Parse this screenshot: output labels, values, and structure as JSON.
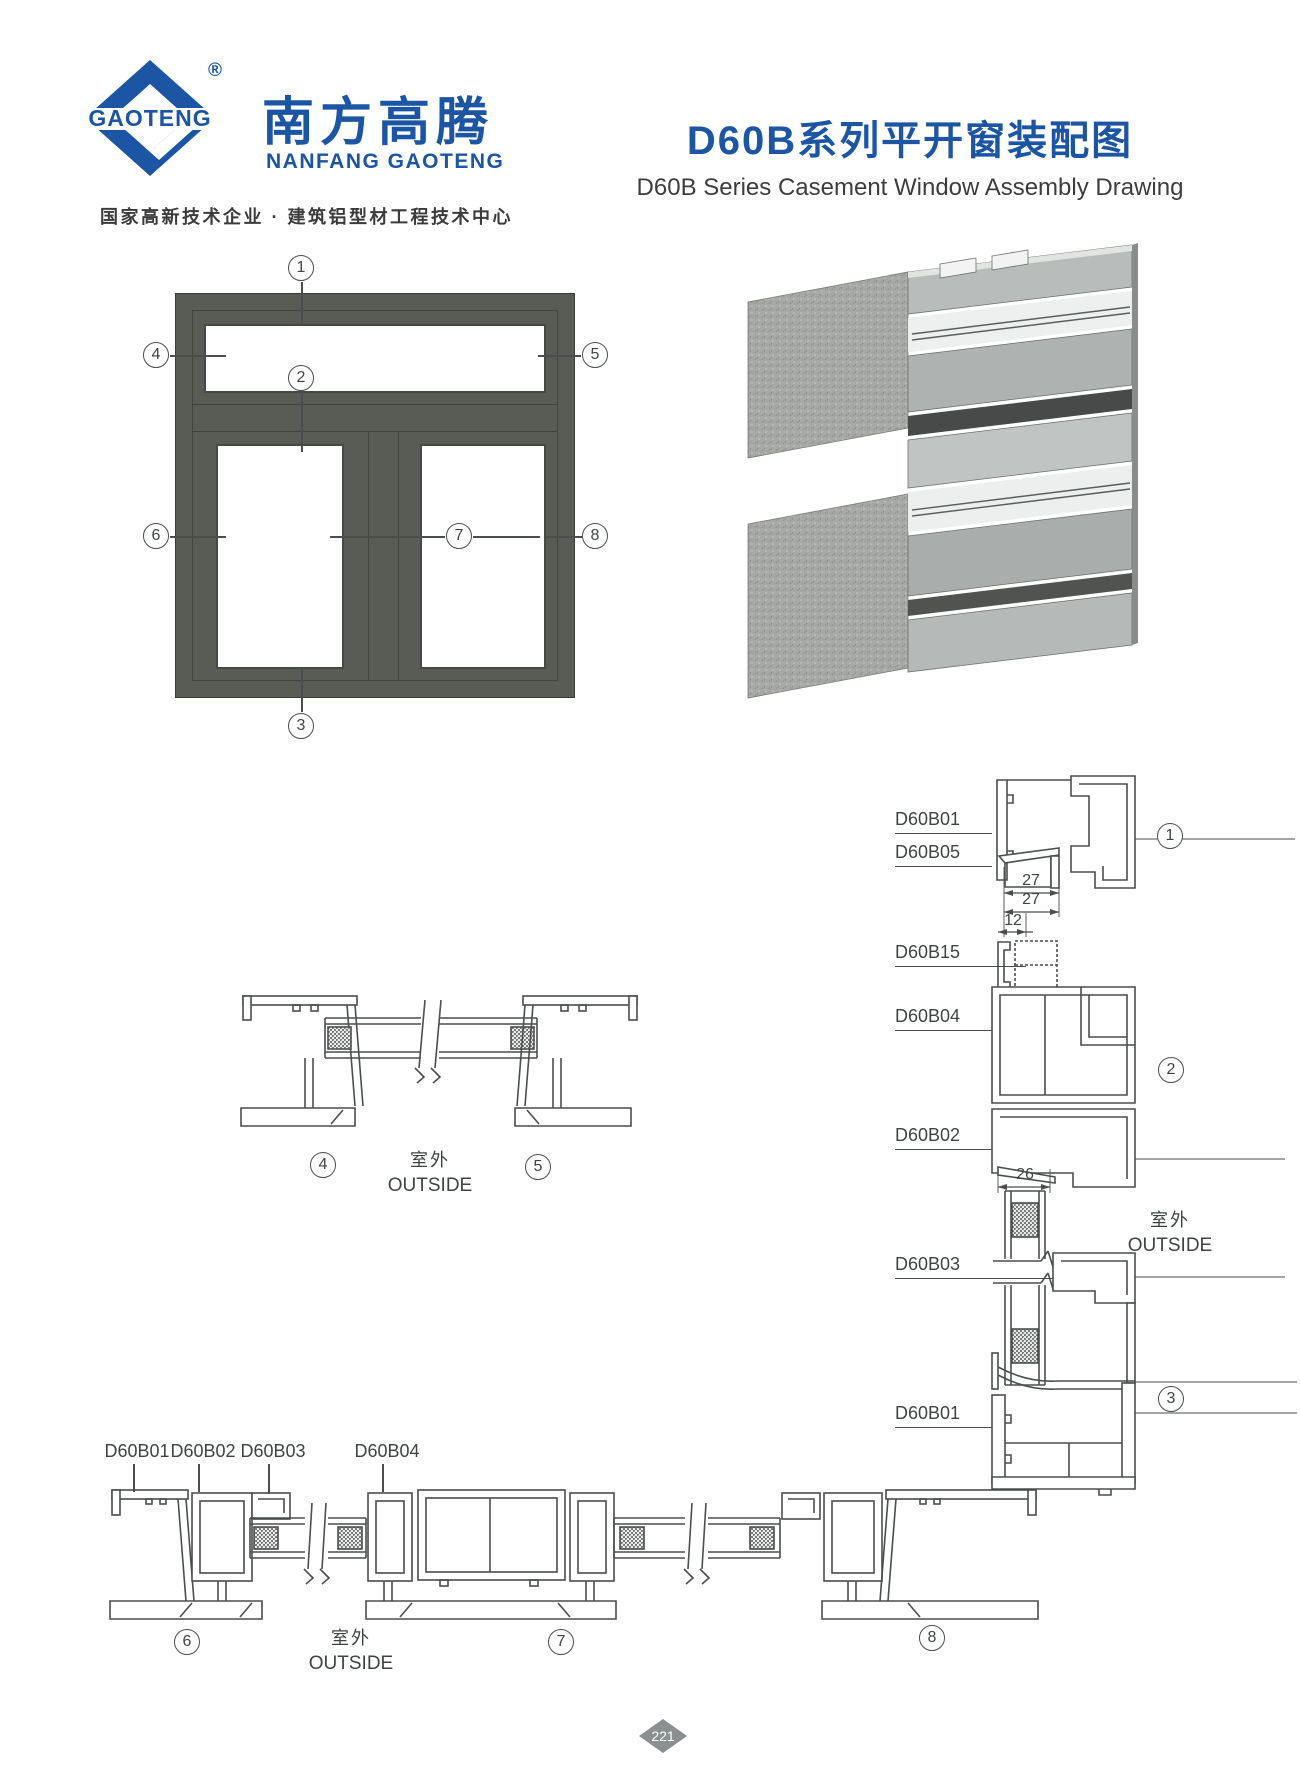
{
  "header": {
    "logo": {
      "mark": "GAOTENG",
      "registered": "®",
      "brand_cn": "南方高腾",
      "brand_en": "NANFANG GAOTENG",
      "tagline": "国家高新技术企业 · 建筑铝型材工程技术中心"
    },
    "title_cn": "D60B系列平开窗装配图",
    "title_en": "D60B Series Casement Window Assembly Drawing"
  },
  "elevation": {
    "callouts": [
      "1",
      "2",
      "3",
      "4",
      "5",
      "6",
      "7",
      "8"
    ]
  },
  "mid_section": {
    "callouts": [
      "4",
      "5"
    ],
    "outside_cn": "室外",
    "outside_en": "OUTSIDE"
  },
  "vertical_section": {
    "labels": [
      "D60B01",
      "D60B05",
      "D60B15",
      "D60B04",
      "D60B02",
      "D60B03",
      "D60B01"
    ],
    "dims": [
      "27",
      "27",
      "12",
      "26"
    ],
    "callouts": [
      "1",
      "2",
      "3"
    ],
    "outside_cn": "室外",
    "outside_en": "OUTSIDE"
  },
  "bottom_section": {
    "labels": [
      "D60B01",
      "D60B02",
      "D60B03",
      "D60B04"
    ],
    "callouts": [
      "6",
      "7",
      "8"
    ],
    "outside_cn": "室外",
    "outside_en": "OUTSIDE"
  },
  "footer": {
    "page": "221"
  },
  "colors": {
    "brand_blue": "#1b55a4",
    "line_gray": "#4a4e4d",
    "frame_gray": "#595c55"
  }
}
